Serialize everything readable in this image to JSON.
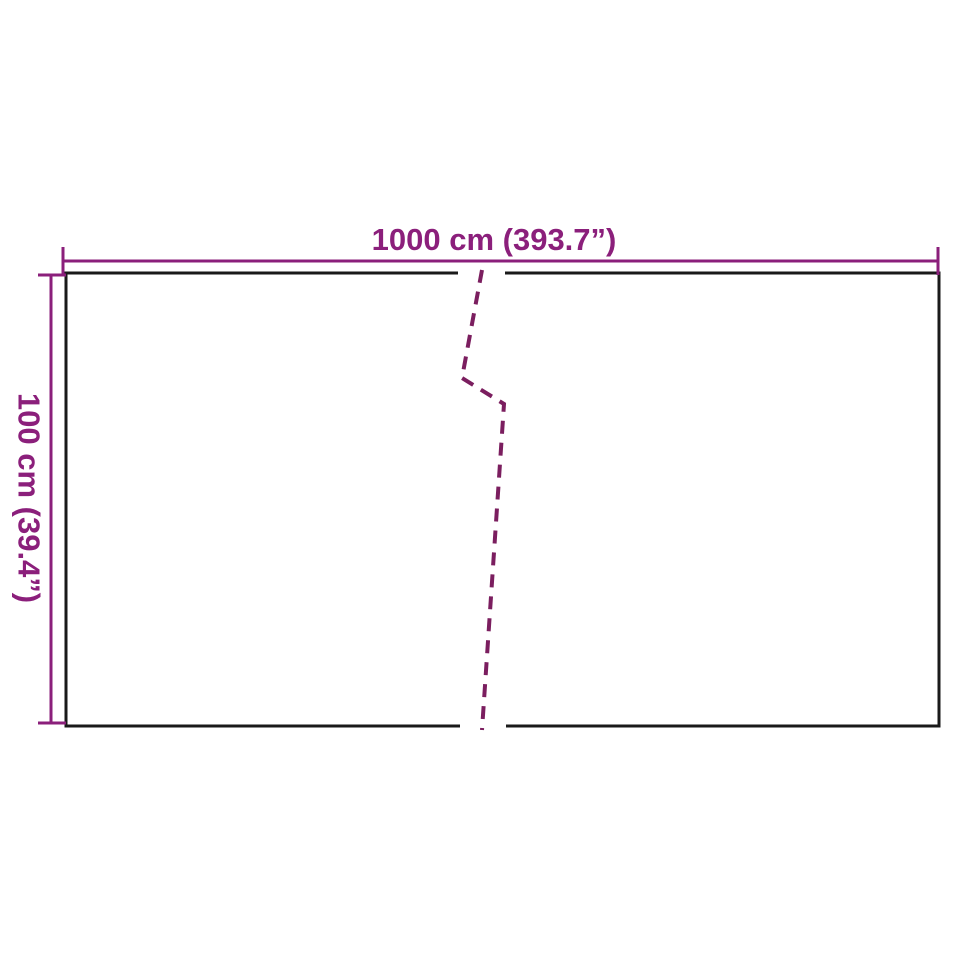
{
  "diagram": {
    "width_label": "1000 cm (393.7”)",
    "height_label": "100 cm (39.4”)",
    "width_cm": 1000,
    "width_inches": 393.7,
    "height_cm": 100,
    "height_inches": 39.4,
    "colors": {
      "dimension_line": "#8b1f7b",
      "break_line": "#7b1e5f",
      "outline": "#1a1a1a",
      "background": "#ffffff"
    }
  }
}
